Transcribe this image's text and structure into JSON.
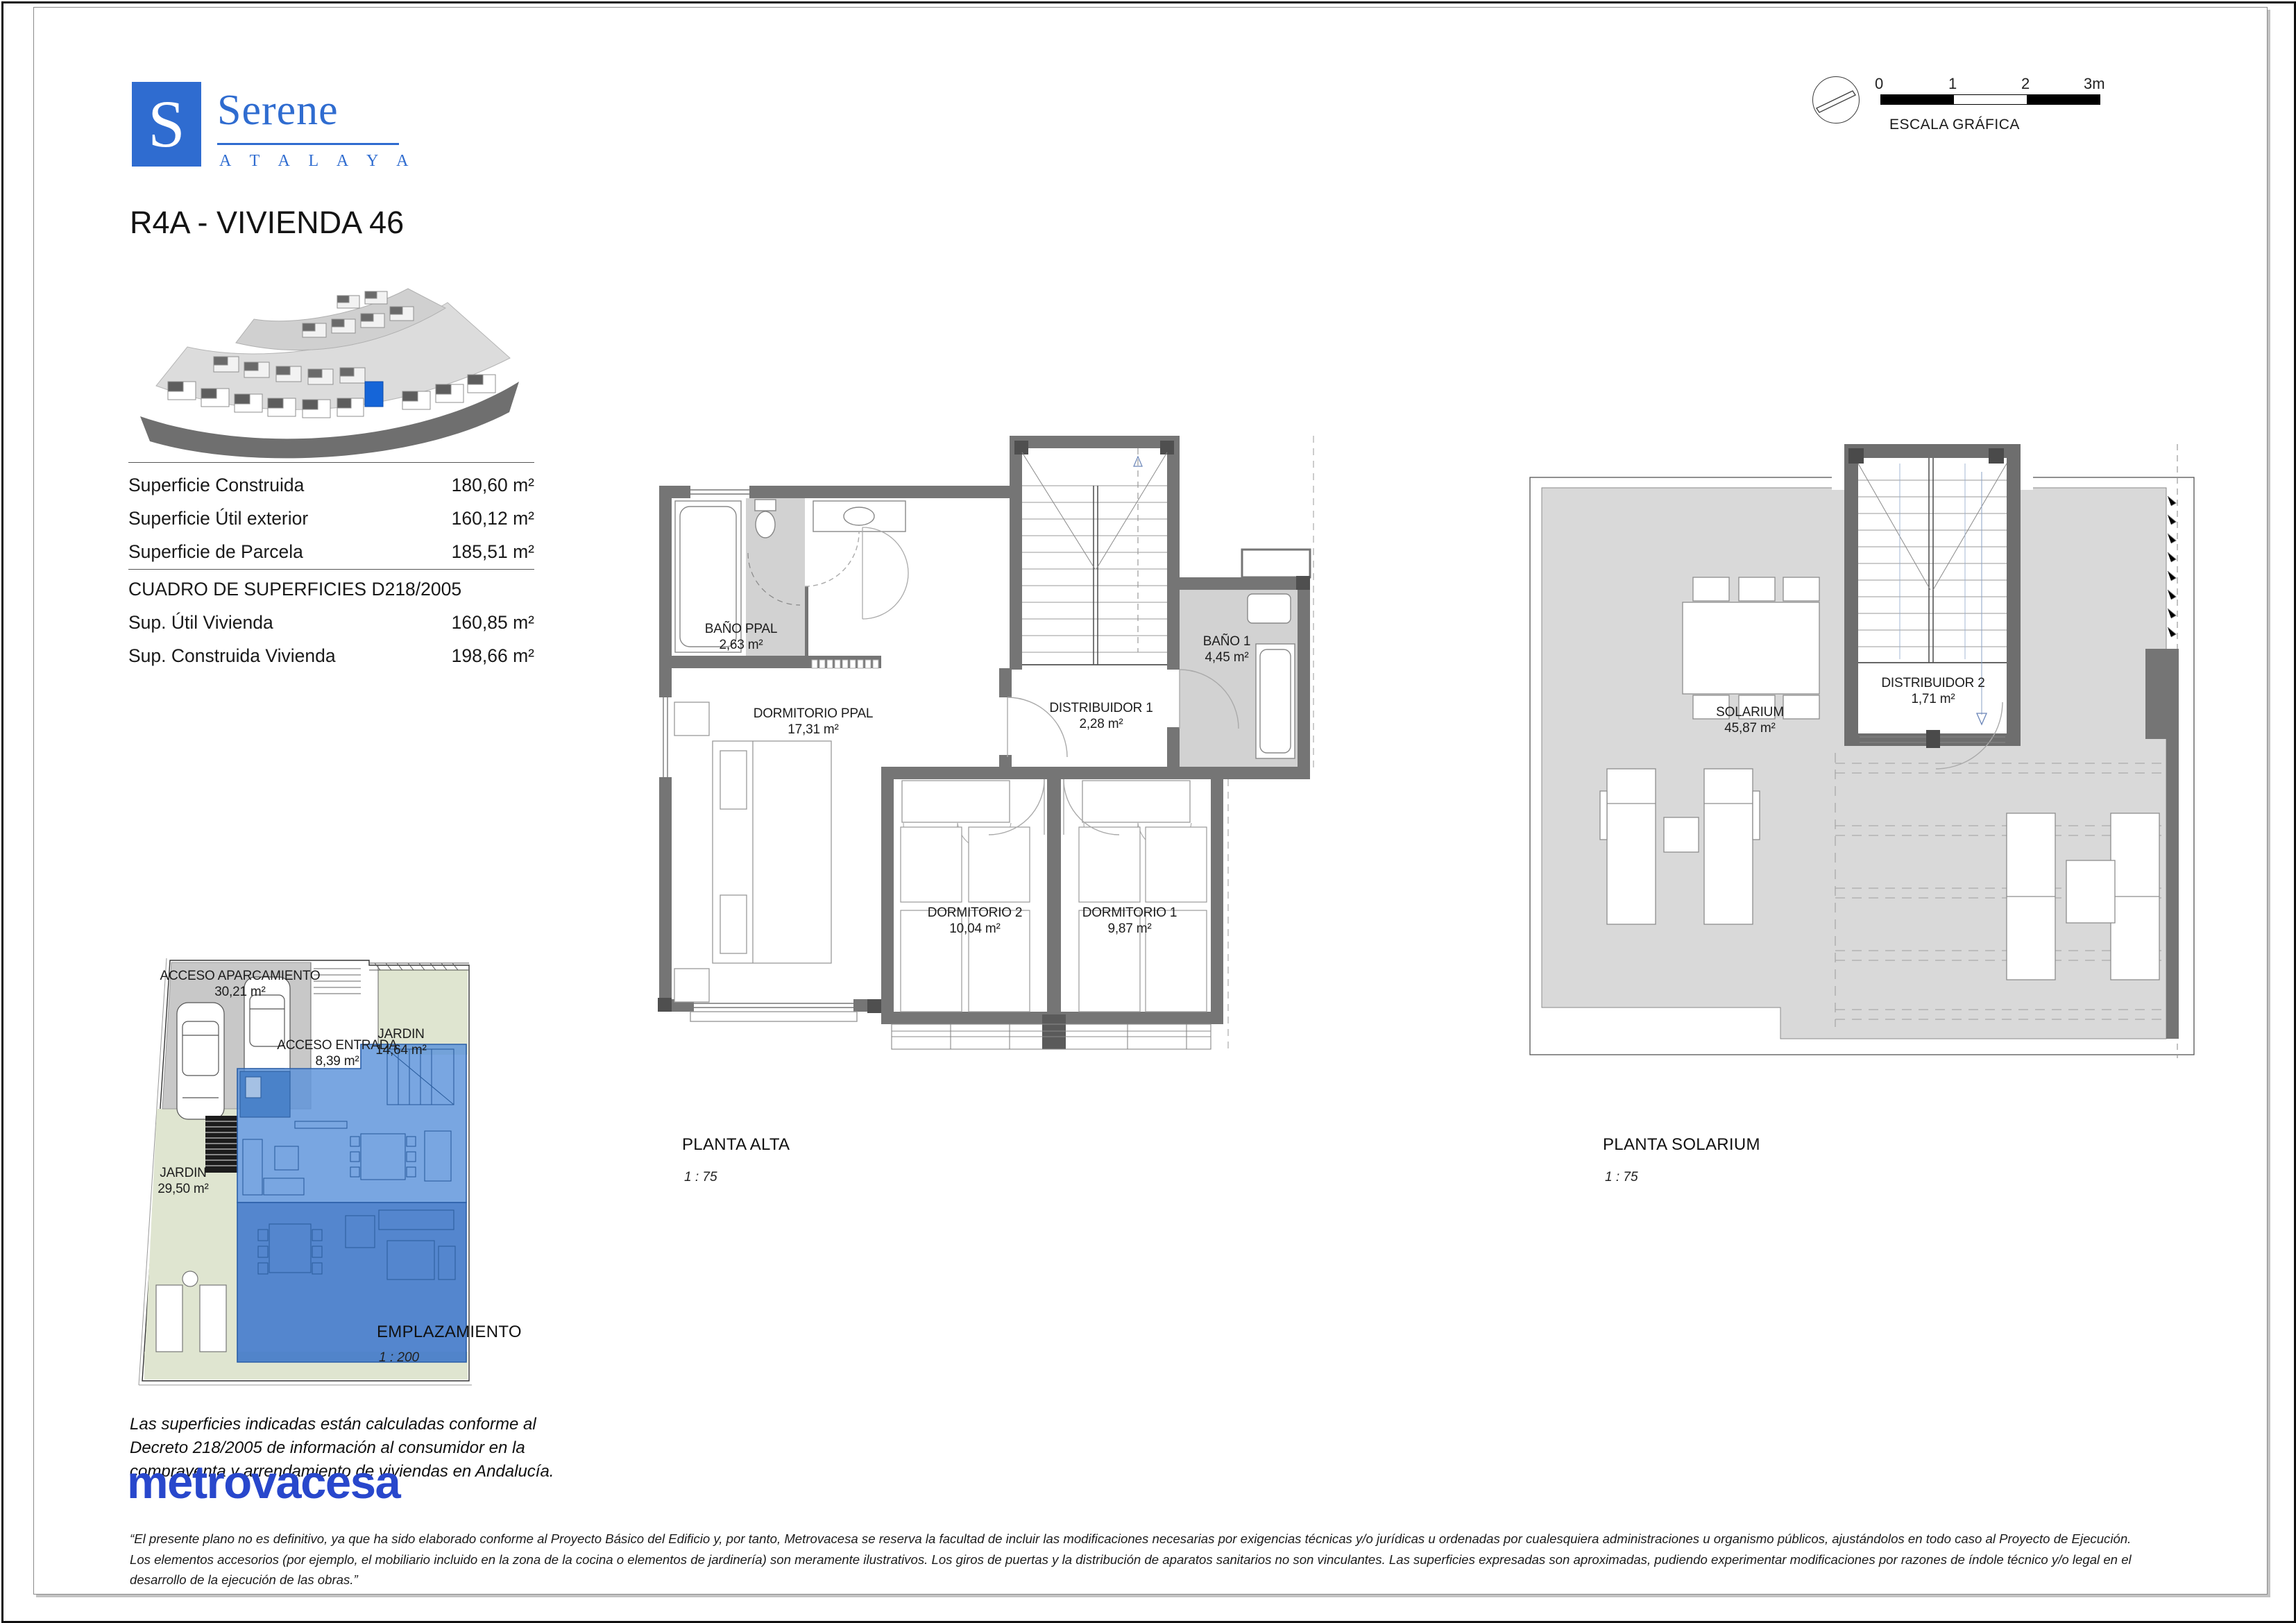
{
  "header": {
    "logo_letter": "S",
    "brand": "Serene",
    "brand_sub": "A T A L A Y A",
    "title": "R4A - VIVIENDA 46"
  },
  "scale_graphic": {
    "ticks": [
      "0",
      "1",
      "2",
      "3m"
    ],
    "label": "ESCALA GRÁFICA"
  },
  "surface_table": {
    "rows": [
      {
        "label": "Superficie Construida",
        "value": "180,60 m²"
      },
      {
        "label": "Superficie Útil exterior",
        "value": "160,12 m²"
      },
      {
        "label": "Superficie de Parcela",
        "value": "185,51 m²"
      }
    ],
    "section_title": "CUADRO DE SUPERFICIES D218/2005",
    "section_rows": [
      {
        "label": "Sup. Útil Vivienda",
        "value": "160,85 m²"
      },
      {
        "label": "Sup. Construida Vivienda",
        "value": "198,66 m²"
      }
    ]
  },
  "planta_alta": {
    "caption": "PLANTA ALTA",
    "scale": "1 : 75",
    "rooms": [
      {
        "name": "BAÑO PPAL",
        "area": "2,63 m²"
      },
      {
        "name": "DORMITORIO PPAL",
        "area": "17,31 m²"
      },
      {
        "name": "DISTRIBUIDOR 1",
        "area": "2,28 m²"
      },
      {
        "name": "BAÑO 1",
        "area": "4,45 m²"
      },
      {
        "name": "DORMITORIO 2",
        "area": "10,04 m²"
      },
      {
        "name": "DORMITORIO 1",
        "area": "9,87 m²"
      }
    ]
  },
  "planta_solarium": {
    "caption": "PLANTA SOLARIUM",
    "scale": "1 : 75",
    "rooms": [
      {
        "name": "SOLARIUM",
        "area": "45,87 m²"
      },
      {
        "name": "DISTRIBUIDOR 2",
        "area": "1,71 m²"
      }
    ]
  },
  "emplazamiento": {
    "caption": "EMPLAZAMIENTO",
    "scale": "1 : 200",
    "zones": [
      {
        "name": "ACCESO APARCAMIENTO",
        "area": "30,21 m²"
      },
      {
        "name": "ACCESO ENTRADA",
        "area": "8,39 m²"
      },
      {
        "name": "JARDIN",
        "area": "14,64 m²"
      },
      {
        "name": "JARDIN",
        "area": "29,50 m²"
      }
    ]
  },
  "footer": {
    "decree_note_lines": [
      "Las superficies indicadas están calculadas conforme al",
      "Decreto 218/2005 de información al consumidor en la",
      "compraventa y arrendamiento de viviendas en Andalucía."
    ],
    "brand": "metrovacesa",
    "disclaimer_lines": [
      "“El presente plano no es definitivo, ya que ha sido elaborado conforme al Proyecto Básico del Edificio y, por tanto, Metrovacesa se reserva la facultad de incluir las modificaciones necesarias por exigencias técnicas y/o jurídicas u ordenadas por cualesquiera administraciones u organismo públicos, ajustándolos en todo caso al Proyecto de Ejecución.",
      "Los elementos accesorios (por ejemplo, el mobiliario incluido en la zona de la cocina o elementos de jardinería) son meramente ilustrativos. Los giros de puertas y la distribución de aparatos sanitarios no son vinculantes. Las superficies expresadas son aproximadas, pudiendo experimentar modificaciones por razones de índole técnico y/o legal en el",
      "desarrollo de la ejecución de las obras.”"
    ]
  },
  "colors": {
    "brand_blue": "#2f6cd0",
    "metrovacesa_blue": "#2847cc",
    "wall_gray": "#757575",
    "bath_floor_gray": "#d2d2d2",
    "terrace_gray": "#d9d9d9",
    "garden_green": "#dfe5d0",
    "parking_gray": "#c8c8c8",
    "house_blue": "#5b93db",
    "house_terrace_blue": "#4179c9",
    "highlight_blue": "#1565d8"
  }
}
